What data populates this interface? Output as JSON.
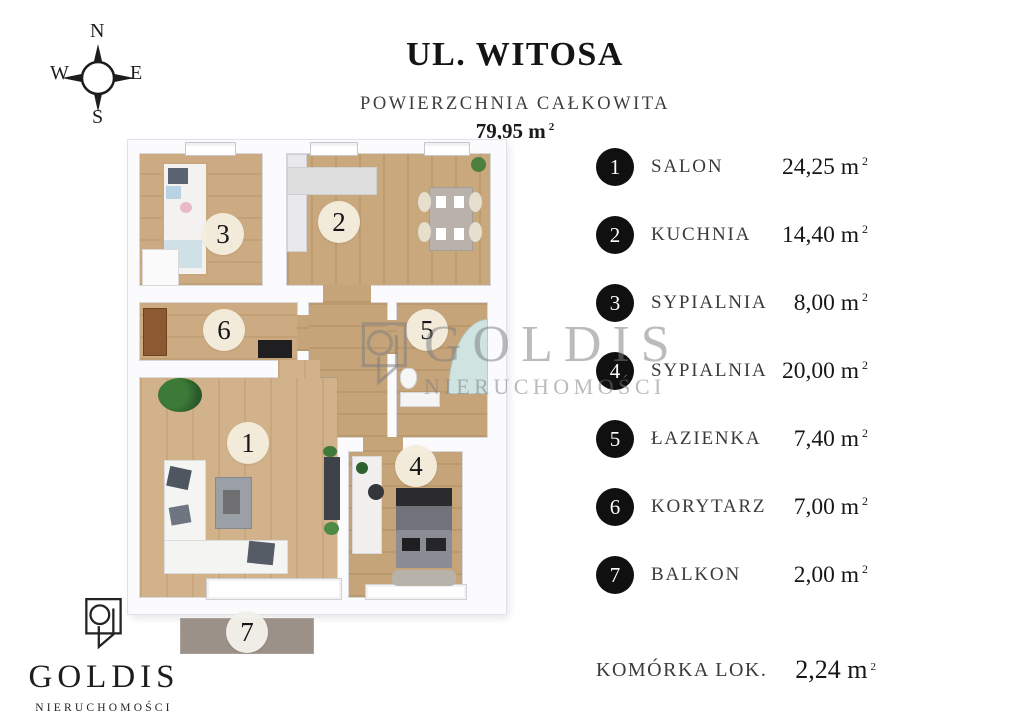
{
  "compass": {
    "n": "N",
    "e": "E",
    "s": "S",
    "w": "W"
  },
  "header": {
    "title": "UL. WITOSA",
    "subtitle": "POWIERZCHNIA CAŁKOWITA",
    "total_area": "79,95",
    "unit_base": "m",
    "unit_sup": "2"
  },
  "legend": {
    "unit_base": "m",
    "unit_sup": "2",
    "items": [
      {
        "number": "1",
        "label": "SALON",
        "area": "24,25"
      },
      {
        "number": "2",
        "label": "KUCHNIA",
        "area": "14,40"
      },
      {
        "number": "3",
        "label": "SYPIALNIA",
        "area": "8,00"
      },
      {
        "number": "4",
        "label": "SYPIALNIA",
        "area": "20,00"
      },
      {
        "number": "5",
        "label": "ŁAZIENKA",
        "area": "7,40"
      },
      {
        "number": "6",
        "label": "KORYTARZ",
        "area": "7,00"
      },
      {
        "number": "7",
        "label": "BALKON",
        "area": "2,00"
      }
    ],
    "extra": {
      "label": "KOMÓRKA LOK.",
      "area": "2,24"
    }
  },
  "plan": {
    "room_numbers": [
      "1",
      "2",
      "3",
      "4",
      "5",
      "6",
      "7"
    ]
  },
  "watermark": {
    "name": "GOLDIS",
    "tagline": "NIERUCHOMOŚCI"
  },
  "footer_logo": {
    "name": "GOLDIS",
    "tagline": "NIERUCHOMOŚCI"
  },
  "colors": {
    "wood": "#c9a77c",
    "balcony": "#9c9188",
    "legend_circle": "#111111",
    "room_circle": "#f5eddd"
  }
}
